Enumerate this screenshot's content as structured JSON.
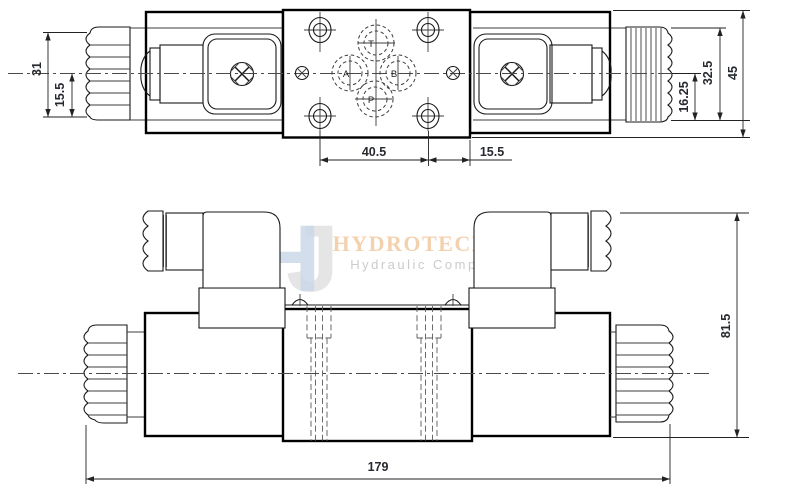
{
  "watermark": {
    "logo_h": "H",
    "logo_j": "J",
    "brand": "HYDROTECHNIK24",
    "tagline": "Hydraulic Components"
  },
  "ports": {
    "t": "T",
    "a": "A",
    "b": "B",
    "p": "P"
  },
  "dims": {
    "solenoid_dia": "31",
    "solenoid_radius": "15.5",
    "hole_span": "40.5",
    "hole_offset": "15.5",
    "port_offset": "16.25",
    "knob_height": "32.5",
    "body_height": "45",
    "total_length": "179",
    "total_height": "81.5"
  },
  "colors": {
    "line": "#000000",
    "dim_text": "#26292e",
    "brand": "#f2c9a2",
    "tagline": "#c6c6c6",
    "logo_blue": "#cbd9e9",
    "logo_gray": "#e1e1e1"
  }
}
